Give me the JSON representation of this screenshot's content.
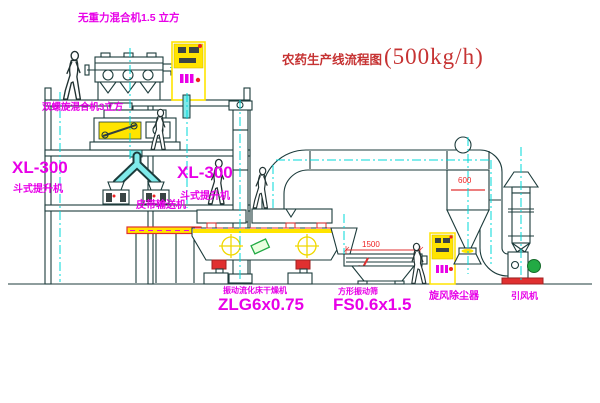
{
  "title": {
    "text": "农药生产线流程图",
    "capacity": "(500kg/h)"
  },
  "labels": {
    "gravity_mixer": "无重力混合机1.5 立方",
    "screw_mixer": "双螺旋混合机3立方",
    "elevator_left_model": "XL-300",
    "elevator_left_type": "斗式提升机",
    "elevator_right_model": "XL-300",
    "elevator_right_type": "斗式提升机",
    "belt_conveyor": "皮带输送机",
    "dryer_type": "振动流化床干燥机",
    "dryer_model": "ZLG6x0.75",
    "screen_type": "方形振动筛",
    "screen_model": "FS0.6x1.5",
    "cyclone": "旋风除尘器",
    "fan": "引风机"
  },
  "dimensions": {
    "screen_length": "1500",
    "cyclone_diameter": "600"
  },
  "colors": {
    "line": "#1c3b3b",
    "centerline_cyan": "#00d8d8",
    "pipe_cyan": "#7feaea",
    "label_magenta": "#e800e8",
    "title_red": "#c63333",
    "dimension_red": "#ee2222",
    "cabinet_yellow": "#ffe400",
    "motor_green": "#22aa44",
    "base_red": "#e03030"
  },
  "icons": {
    "workers": "worker-figure",
    "cabinet_buttons": "control-panel-buttons-icon",
    "indicator": "red-indicator-light-icon"
  }
}
